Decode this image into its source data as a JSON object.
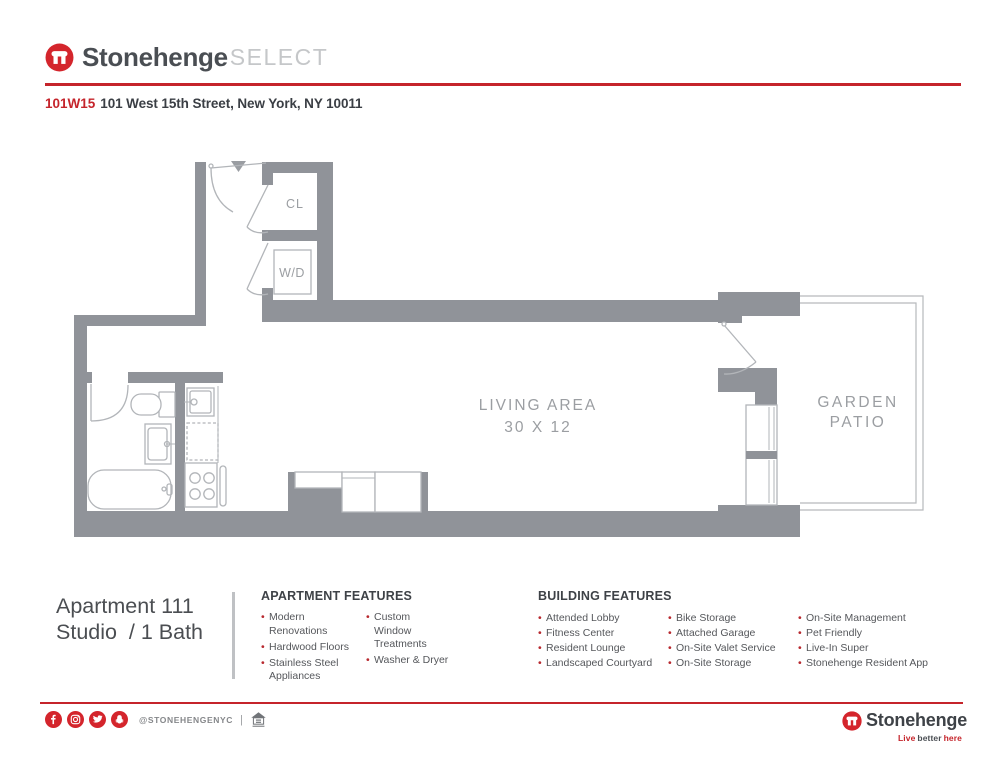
{
  "header": {
    "brand": "Stonehenge",
    "brand_suffix": "SELECT",
    "building_code": "101W15",
    "address": "101 West 15th Street, New York, NY 10011"
  },
  "floorplan": {
    "labels": {
      "closet": "CL",
      "washer_dryer": "W/D",
      "living1": "LIVING AREA",
      "living2": "30 X 12",
      "patio1": "GARDEN",
      "patio2": "PATIO"
    }
  },
  "unit": {
    "title": "Apartment 111",
    "subtitle": "Studio  / 1 Bath"
  },
  "apartment_features": {
    "heading": "APARTMENT FEATURES",
    "col1": [
      "Modern Renovations",
      "Hardwood Floors",
      "Stainless Steel Appliances"
    ],
    "col2": [
      "Custom Window Treatments",
      "Washer & Dryer"
    ]
  },
  "building_features": {
    "heading": "BUILDING FEATURES",
    "col1": [
      "Attended Lobby",
      "Fitness Center",
      "Resident Lounge",
      "Landscaped Courtyard"
    ],
    "col2": [
      "Bike Storage",
      "Attached Garage",
      "On-Site Valet Service",
      "On-Site Storage"
    ],
    "col3": [
      "On-Site Management",
      "Pet Friendly",
      "Live-In Super",
      "Stonehenge Resident App"
    ]
  },
  "footer": {
    "handle": "@STONEHENGENYC",
    "separator": "|",
    "equal_housing": "equal-housing-opportunity",
    "brand": "Stonehenge",
    "tagline": [
      "Live",
      "better",
      "here"
    ]
  },
  "colors": {
    "brand_red": "#c5242b",
    "icon_red": "#d4252c",
    "wall_gray": "#909399",
    "fixture_gray": "#b2b5b9",
    "label_gray": "#9b9ea2",
    "text_dark": "#3e4247"
  }
}
